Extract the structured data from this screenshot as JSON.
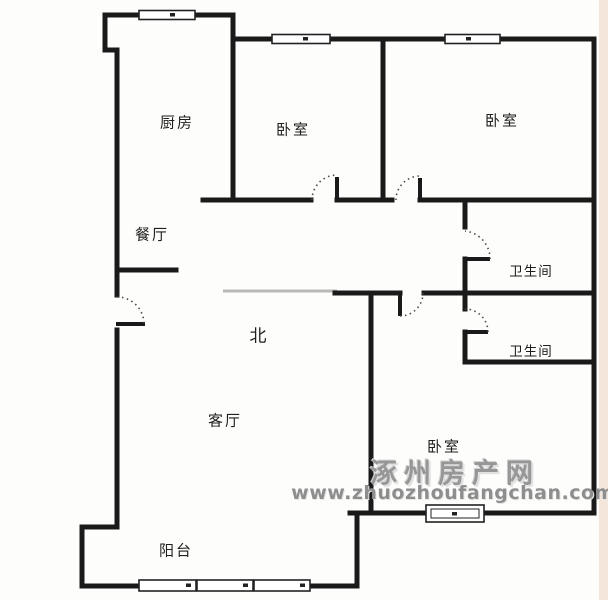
{
  "rooms": {
    "kitchen": {
      "label": "厨房"
    },
    "bedroom_top_mid": {
      "label": "卧室"
    },
    "bedroom_top_right": {
      "label": "卧室"
    },
    "dining": {
      "label": "餐厅"
    },
    "bathroom_upper": {
      "label": "卫生间"
    },
    "bathroom_lower": {
      "label": "卫生间"
    },
    "living": {
      "label": "客厅"
    },
    "bedroom_bottom": {
      "label": "卧室"
    },
    "balcony": {
      "label": "阳台"
    }
  },
  "compass": {
    "north_label": "北"
  },
  "watermark": {
    "site_name": "涿州房产网",
    "site_url": "www.zhuozhoufangchan.com"
  },
  "colors": {
    "wall": "#1a1a1a",
    "faint_wall": "#b9b9b9",
    "door_arc": "#4a4a4a",
    "window_border": "#222222",
    "watermark_gray": "#979797",
    "background": "#fdfdfb",
    "edge_strip": "#f4e6da"
  }
}
